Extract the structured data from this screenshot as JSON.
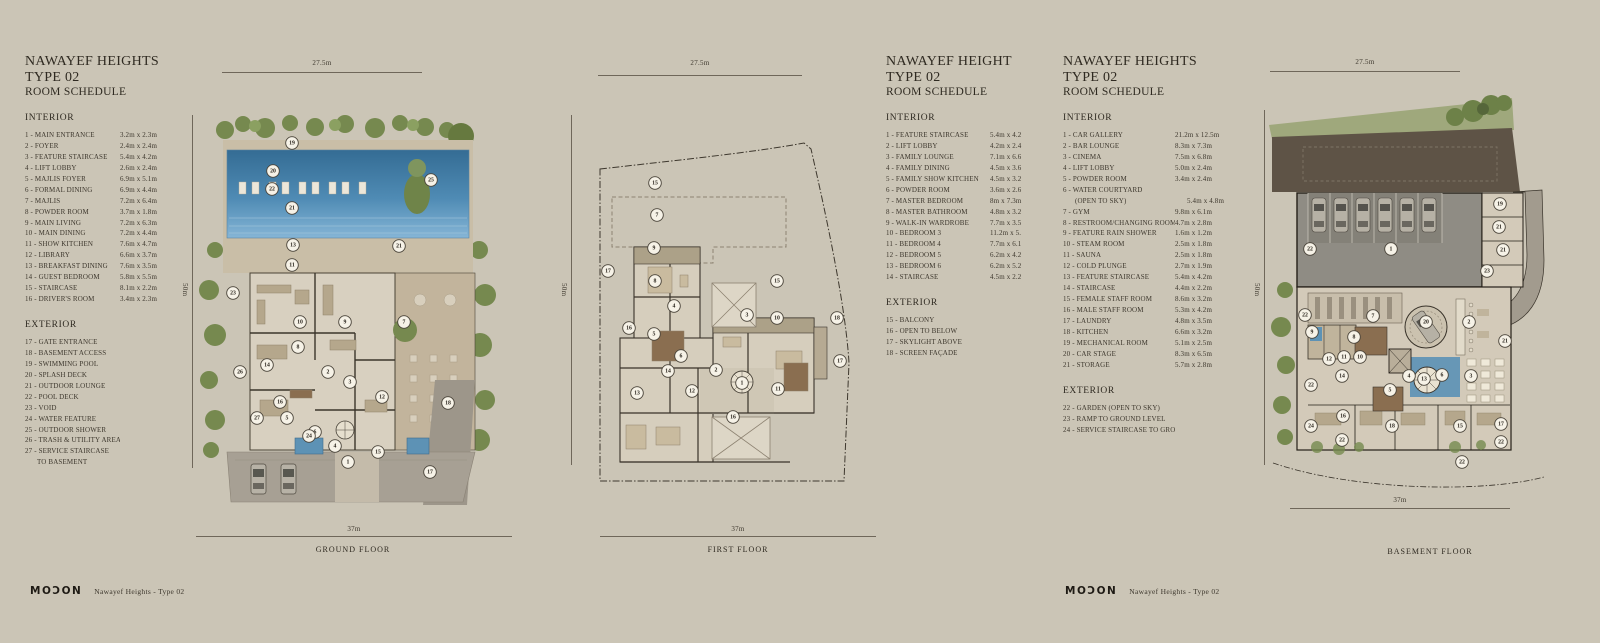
{
  "colors": {
    "bg": "#cbc5b6",
    "ink": "#38332a",
    "pool": "#4f8bb4",
    "tree": "#76894f",
    "earth": "#5e5346"
  },
  "schedules": [
    {
      "title_lines": [
        "NAWAYEF HEIGHTS",
        "TYPE 02",
        "ROOM SCHEDULE"
      ],
      "interior_heading": "INTERIOR",
      "exterior_heading": "EXTERIOR",
      "interior": [
        {
          "label": "1 - MAIN ENTRANCE",
          "dim": "3.2m x 2.3m"
        },
        {
          "label": "2 - FOYER",
          "dim": "2.4m x 2.4m"
        },
        {
          "label": "3 - FEATURE STAIRCASE",
          "dim": "5.4m x 4.2m"
        },
        {
          "label": "4 - LIFT LOBBY",
          "dim": "2.6m x 2.4m"
        },
        {
          "label": "5 - MAJLIS FOYER",
          "dim": "6.9m x 5.1m"
        },
        {
          "label": "6 - FORMAL DINING",
          "dim": "6.9m x 4.4m"
        },
        {
          "label": "7 - MAJLIS",
          "dim": "7.2m x 6.4m"
        },
        {
          "label": "8 - POWDER ROOM",
          "dim": "3.7m x 1.8m"
        },
        {
          "label": "9 - MAIN LIVING",
          "dim": "7.2m x 6.3m"
        },
        {
          "label": "10 - MAIN DINING",
          "dim": "7.2m x 4.4m"
        },
        {
          "label": "11 - SHOW KITCHEN",
          "dim": "7.6m x 4.7m"
        },
        {
          "label": "12 - LIBRARY",
          "dim": "6.6m x 3.7m"
        },
        {
          "label": "13 - BREAKFAST DINING",
          "dim": "7.6m x 3.5m"
        },
        {
          "label": "14 - GUEST BEDROOM",
          "dim": "5.8m x 5.5m"
        },
        {
          "label": "15 - STAIRCASE",
          "dim": "8.1m x 2.2m"
        },
        {
          "label": "16 - DRIVER'S ROOM",
          "dim": "3.4m x 2.3m"
        }
      ],
      "exterior": [
        {
          "label": "17 - GATE ENTRANCE"
        },
        {
          "label": "18 - BASEMENT ACCESS"
        },
        {
          "label": "19 - SWIMMING POOL"
        },
        {
          "label": "20 - SPLASH DECK"
        },
        {
          "label": "21 - OUTDOOR LOUNGE"
        },
        {
          "label": "22 - POOL DECK"
        },
        {
          "label": "23 - VOID"
        },
        {
          "label": "24 - WATER FEATURE"
        },
        {
          "label": "25 - OUTDOOR SHOWER"
        },
        {
          "label": "26 - TRASH & UTILITY AREA"
        },
        {
          "label": "27 - SERVICE STAIRCASE",
          "label2": "TO BASEMENT"
        }
      ]
    },
    {
      "title_lines": [
        "NAWAYEF HEIGHT",
        "TYPE 02",
        "ROOM SCHEDULE"
      ],
      "interior_heading": "INTERIOR",
      "exterior_heading": "EXTERIOR",
      "interior": [
        {
          "label": "1 - FEATURE STAIRCASE",
          "dim": "5.4m x 4.2"
        },
        {
          "label": "2 - LIFT LOBBY",
          "dim": "4.2m x 2.4"
        },
        {
          "label": "3 - FAMILY LOUNGE",
          "dim": "7.1m x 6.6"
        },
        {
          "label": "4 - FAMILY DINING",
          "dim": "4.5m x 3.6"
        },
        {
          "label": "5 - FAMILY SHOW KITCHEN",
          "dim": "4.5m x 3.2"
        },
        {
          "label": "6 - POWDER ROOM",
          "dim": "3.6m x 2.6"
        },
        {
          "label": "7 - MASTER BEDROOM",
          "dim": "8m x 7.3m"
        },
        {
          "label": "8 - MASTER BATHROOM",
          "dim": "4.8m x 3.2"
        },
        {
          "label": "9 - WALK-IN WARDROBE",
          "dim": "7.7m x 3.5"
        },
        {
          "label": "10 - BEDROOM 3",
          "dim": "11.2m x 5."
        },
        {
          "label": "11 - BEDROOM 4",
          "dim": "7.7m x 6.1"
        },
        {
          "label": "12 - BEDROOM 5",
          "dim": "6.2m x 4.2"
        },
        {
          "label": "13 - BEDROOM 6",
          "dim": "6.2m x 5.2"
        },
        {
          "label": "14 - STAIRCASE",
          "dim": "4.5m x 2.2"
        }
      ],
      "exterior": [
        {
          "label": "15 - BALCONY"
        },
        {
          "label": "16 - OPEN TO BELOW"
        },
        {
          "label": "17 - SKYLIGHT ABOVE"
        },
        {
          "label": "18 - SCREEN FAÇADE"
        }
      ]
    },
    {
      "title_lines": [
        "NAWAYEF HEIGHTS",
        "TYPE 02",
        "ROOM SCHEDULE"
      ],
      "interior_heading": "INTERIOR",
      "exterior_heading": "EXTERIOR",
      "interior": [
        {
          "label": "1 - CAR GALLERY",
          "dim": "21.2m x 12.5m"
        },
        {
          "label": "2 - BAR LOUNGE",
          "dim": "8.3m x 7.3m"
        },
        {
          "label": "3 - CINEMA",
          "dim": "7.5m x 6.8m"
        },
        {
          "label": "4 - LIFT LOBBY",
          "dim": "5.0m x 2.4m"
        },
        {
          "label": "5 - POWDER ROOM",
          "dim": "3.4m x 2.4m"
        },
        {
          "label": "6 - WATER COURTYARD",
          "label2": "(OPEN TO SKY)",
          "dim": "5.4m x 4.8m"
        },
        {
          "label": "7 - GYM",
          "dim": "9.8m x 6.1m"
        },
        {
          "label": "8 - RESTROOM/CHANGING ROOM",
          "dim": "4.7m x 2.8m"
        },
        {
          "label": "9 - FEATURE RAIN SHOWER",
          "dim": "1.6m x 1.2m"
        },
        {
          "label": "10 - STEAM ROOM",
          "dim": "2.5m x 1.8m"
        },
        {
          "label": "11 - SAUNA",
          "dim": "2.5m x 1.8m"
        },
        {
          "label": "12 - COLD PLUNGE",
          "dim": "2.7m x 1.9m"
        },
        {
          "label": "13 - FEATURE STAIRCASE",
          "dim": "5.4m x 4.2m"
        },
        {
          "label": "14 - STAIRCASE",
          "dim": "4.4m x 2.2m"
        },
        {
          "label": "15 - FEMALE STAFF ROOM",
          "dim": "8.6m x 3.2m"
        },
        {
          "label": "16 - MALE STAFF ROOM",
          "dim": "5.3m x 4.2m"
        },
        {
          "label": "17 - LAUNDRY",
          "dim": "4.8m x 3.5m"
        },
        {
          "label": "18 - KITCHEN",
          "dim": "6.6m x 3.2m"
        },
        {
          "label": "19 - MECHANICAL ROOM",
          "dim": "5.1m x 2.5m"
        },
        {
          "label": "20 - CAR STAGE",
          "dim": "8.3m x 6.5m"
        },
        {
          "label": "21 - STORAGE",
          "dim": "5.7m x 2.8m"
        }
      ],
      "exterior": [
        {
          "label": "22 - GARDEN (OPEN TO SKY)"
        },
        {
          "label": "23 - RAMP TO GROUND LEVEL"
        },
        {
          "label": "24 - SERVICE STAIRCASE TO GROUND"
        }
      ]
    }
  ],
  "plans": [
    {
      "name": "GROUND FLOOR",
      "top_dim": "27.5m",
      "side_dim": "50m",
      "bottom_dim": "37m",
      "markers": [
        [
          19,
          97,
          43
        ],
        [
          20,
          78,
          71
        ],
        [
          25,
          236,
          80
        ],
        [
          22,
          77,
          89
        ],
        [
          21,
          97,
          108
        ],
        [
          13,
          98,
          145
        ],
        [
          11,
          97,
          165
        ],
        [
          21,
          204,
          146
        ],
        [
          23,
          38,
          193
        ],
        [
          10,
          105,
          222
        ],
        [
          9,
          150,
          222
        ],
        [
          7,
          209,
          222
        ],
        [
          8,
          103,
          247
        ],
        [
          14,
          72,
          265
        ],
        [
          26,
          45,
          272
        ],
        [
          2,
          133,
          272
        ],
        [
          3,
          155,
          282
        ],
        [
          12,
          187,
          297
        ],
        [
          16,
          85,
          302
        ],
        [
          27,
          62,
          318
        ],
        [
          5,
          92,
          318
        ],
        [
          6,
          120,
          332
        ],
        [
          24,
          114,
          336
        ],
        [
          4,
          140,
          346
        ],
        [
          15,
          183,
          352
        ],
        [
          1,
          153,
          362
        ],
        [
          18,
          253,
          303
        ],
        [
          17,
          235,
          372
        ]
      ]
    },
    {
      "name": "FIRST FLOOR",
      "top_dim": "27.5m",
      "side_dim": "50m",
      "bottom_dim": "37m",
      "markers": [
        [
          15,
          95,
          78
        ],
        [
          7,
          97,
          110
        ],
        [
          9,
          94,
          143
        ],
        [
          17,
          48,
          166
        ],
        [
          8,
          95,
          176
        ],
        [
          15,
          217,
          176
        ],
        [
          4,
          114,
          201
        ],
        [
          3,
          187,
          210
        ],
        [
          10,
          217,
          213
        ],
        [
          18,
          277,
          213
        ],
        [
          16,
          69,
          223
        ],
        [
          5,
          94,
          229
        ],
        [
          6,
          121,
          251
        ],
        [
          2,
          156,
          265
        ],
        [
          14,
          108,
          266
        ],
        [
          17,
          280,
          256
        ],
        [
          1,
          182,
          278
        ],
        [
          13,
          77,
          288
        ],
        [
          12,
          132,
          286
        ],
        [
          11,
          218,
          284
        ],
        [
          16,
          173,
          312
        ]
      ]
    },
    {
      "name": "BASEMENT FLOOR",
      "top_dim": "27.5m",
      "side_dim": "50m",
      "bottom_dim": "37m",
      "markers": [
        [
          19,
          245,
          109
        ],
        [
          21,
          244,
          132
        ],
        [
          22,
          55,
          154
        ],
        [
          1,
          136,
          154
        ],
        [
          21,
          248,
          155
        ],
        [
          23,
          232,
          176
        ],
        [
          22,
          50,
          220
        ],
        [
          7,
          118,
          221
        ],
        [
          20,
          171,
          227
        ],
        [
          2,
          214,
          227
        ],
        [
          9,
          57,
          237
        ],
        [
          8,
          99,
          242
        ],
        [
          21,
          250,
          246
        ],
        [
          11,
          89,
          262
        ],
        [
          10,
          105,
          262
        ],
        [
          12,
          74,
          264
        ],
        [
          4,
          154,
          281
        ],
        [
          14,
          87,
          281
        ],
        [
          6,
          187,
          280
        ],
        [
          13,
          169,
          284
        ],
        [
          3,
          216,
          281
        ],
        [
          22,
          56,
          290
        ],
        [
          5,
          135,
          295
        ],
        [
          16,
          88,
          321
        ],
        [
          17,
          246,
          329
        ],
        [
          24,
          56,
          331
        ],
        [
          18,
          137,
          331
        ],
        [
          15,
          205,
          331
        ],
        [
          22,
          87,
          345
        ],
        [
          22,
          246,
          347
        ],
        [
          22,
          207,
          367
        ]
      ]
    }
  ],
  "footers": [
    {
      "logo": "MOƆON",
      "text": "Nawayef Heights - Type 02"
    },
    {
      "logo": "MOƆON",
      "text": "Nawayef Heights - Type 02"
    }
  ]
}
